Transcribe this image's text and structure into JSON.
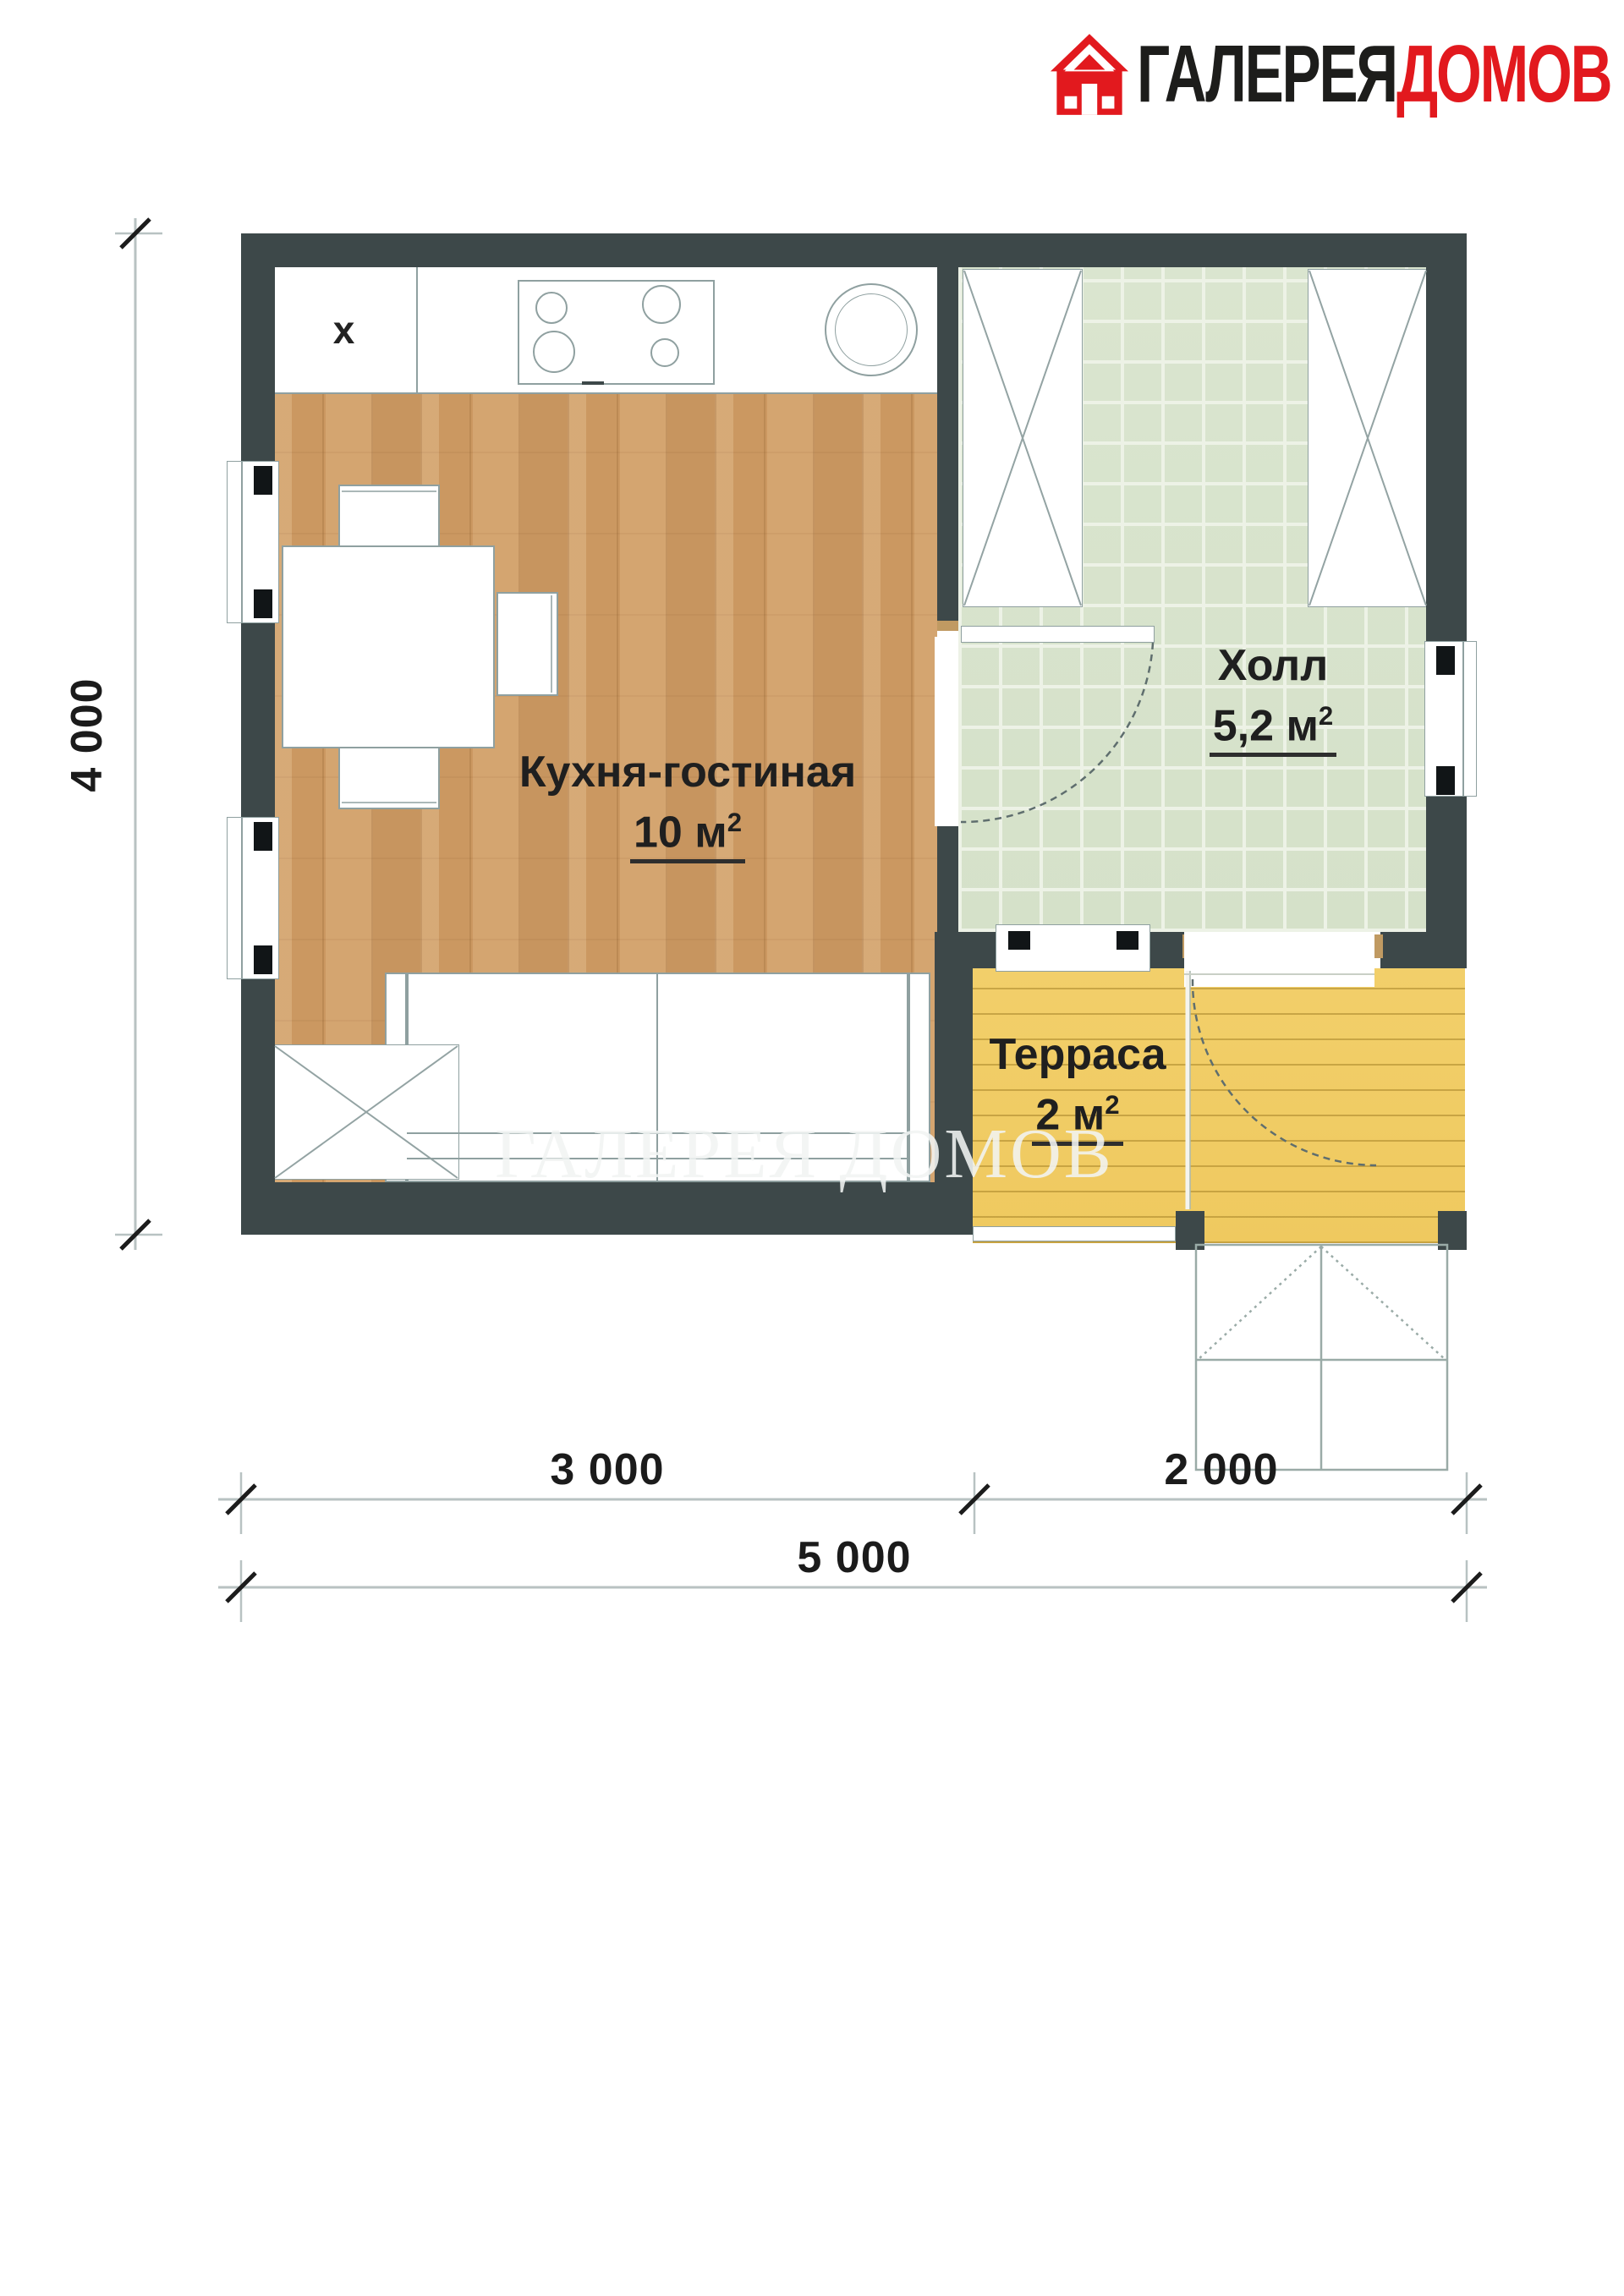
{
  "logo": {
    "brand_black": "ГАЛЕРЕЯ",
    "brand_red": "ДОМОВ"
  },
  "rooms": {
    "kitchen": {
      "name": "Кухня-гостиная",
      "area": "10 м",
      "area_sup": "2"
    },
    "hall": {
      "name": "Холл",
      "area": "5,2 м",
      "area_sup": "2"
    },
    "terrace": {
      "name": "Терраса",
      "area": "2 м",
      "area_sup": "2"
    }
  },
  "dimensions": {
    "height_total": "4 000",
    "width_left": "3 000",
    "width_right": "2 000",
    "width_total": "5 000"
  },
  "plan": {
    "appliance_mark": "x"
  },
  "watermark": "ГАЛЕРЕЯ ДОМОВ",
  "colors": {
    "wall": "#3d4849",
    "wood_floor": "#d2a068",
    "tile_floor": "#dae5cf",
    "terrace_floor": "#f2cf6a",
    "brand_red": "#e2191e"
  }
}
